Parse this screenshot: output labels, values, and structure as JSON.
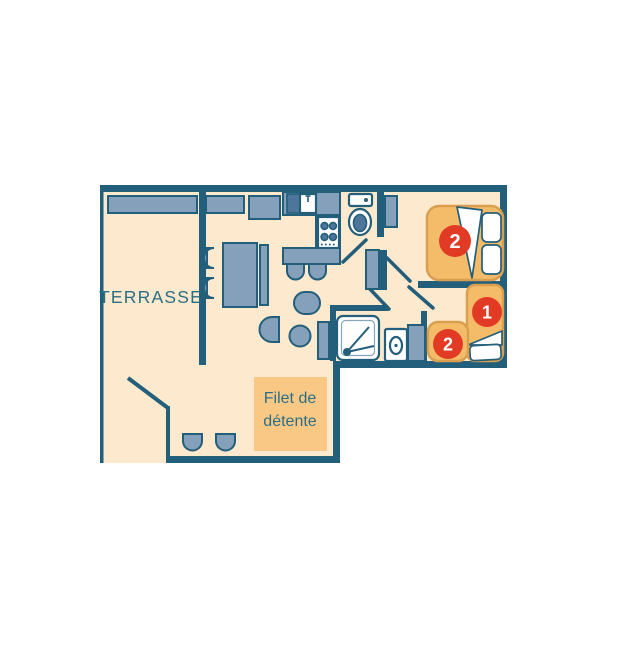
{
  "labels": {
    "terrace": "TERRASSE",
    "relax_line1": "Filet de",
    "relax_line2": "détente"
  },
  "badges": {
    "double_bed": "2",
    "single_bed": "1",
    "pullout_bed": "2"
  },
  "furniture_icons": [
    "terrace-bench",
    "kitchen-cabinet",
    "kitchen-sink",
    "stove",
    "bar-counter",
    "bar-stool",
    "dining-table",
    "dining-chair",
    "dining-bench",
    "armchair",
    "pouf",
    "toilet",
    "shower",
    "washing-machine",
    "wardrobe",
    "double-bed",
    "single-bed",
    "pullout-bed",
    "pillow",
    "duvet-fold",
    "door-swing",
    "floor-stool",
    "relax-net-area"
  ],
  "colors": {
    "background": "#FFFFFF",
    "wall": "#235E7A",
    "floor": "#FCE9CE",
    "furniture": "#84A0BA",
    "appliance": "#4E769A",
    "fixture": "#FFFFFF",
    "bed": "#F4BC68",
    "bed-border": "#D99F4F",
    "badge": "#E23B25",
    "badge-text": "#FFFFFF",
    "relax": "#F9C884",
    "label": "#2A6E84"
  }
}
